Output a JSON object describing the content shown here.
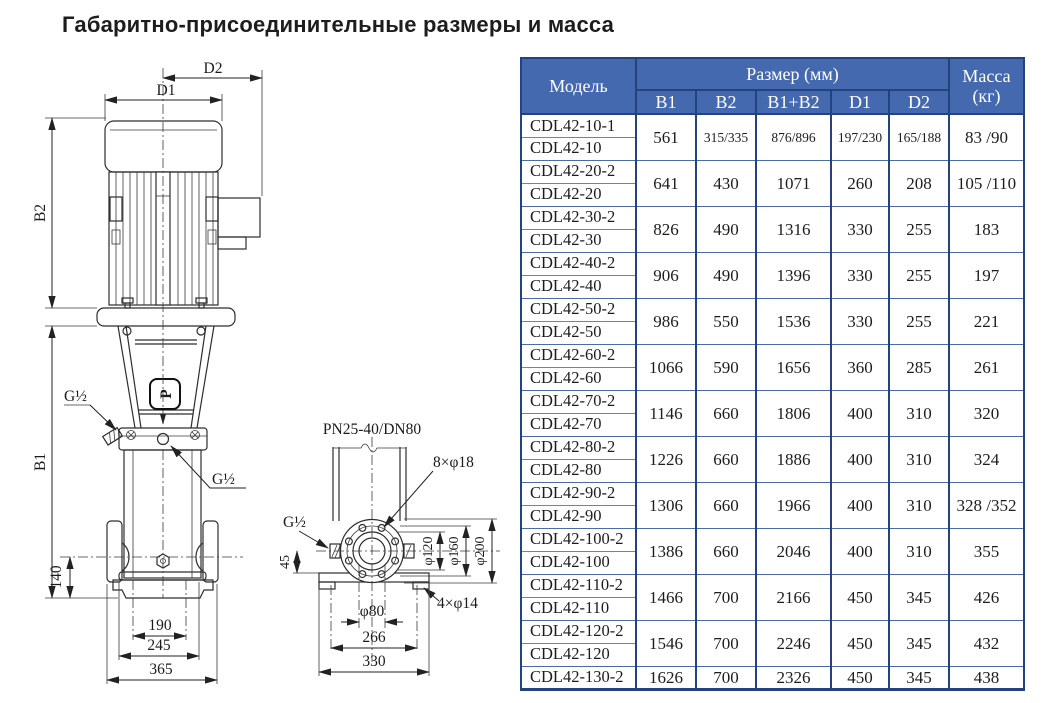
{
  "title": "Габаритно-присоединительные размеры и масса",
  "table": {
    "header": {
      "model": "Модель",
      "size_group": "Размер (мм)",
      "mass": "Масса (кг)",
      "size_cols": [
        "B1",
        "B2",
        "B1+B2",
        "D1",
        "D2"
      ]
    },
    "groups": [
      {
        "models": [
          "CDL42-10-1",
          "CDL42-10"
        ],
        "values": [
          "561",
          "315/335",
          "876/896",
          "197/230",
          "165/188",
          "83 /90"
        ],
        "small": true
      },
      {
        "models": [
          "CDL42-20-2",
          "CDL42-20"
        ],
        "values": [
          "641",
          "430",
          "1071",
          "260",
          "208",
          "105 /110"
        ]
      },
      {
        "models": [
          "CDL42-30-2",
          "CDL42-30"
        ],
        "values": [
          "826",
          "490",
          "1316",
          "330",
          "255",
          "183"
        ]
      },
      {
        "models": [
          "CDL42-40-2",
          "CDL42-40"
        ],
        "values": [
          "906",
          "490",
          "1396",
          "330",
          "255",
          "197"
        ]
      },
      {
        "models": [
          "CDL42-50-2",
          "CDL42-50"
        ],
        "values": [
          "986",
          "550",
          "1536",
          "330",
          "255",
          "221"
        ]
      },
      {
        "models": [
          "CDL42-60-2",
          "CDL42-60"
        ],
        "values": [
          "1066",
          "590",
          "1656",
          "360",
          "285",
          "261"
        ]
      },
      {
        "models": [
          "CDL42-70-2",
          "CDL42-70"
        ],
        "values": [
          "1146",
          "660",
          "1806",
          "400",
          "310",
          "320"
        ]
      },
      {
        "models": [
          "CDL42-80-2",
          "CDL42-80"
        ],
        "values": [
          "1226",
          "660",
          "1886",
          "400",
          "310",
          "324"
        ]
      },
      {
        "models": [
          "CDL42-90-2",
          "CDL42-90"
        ],
        "values": [
          "1306",
          "660",
          "1966",
          "400",
          "310",
          "328 /352"
        ]
      },
      {
        "models": [
          "CDL42-100-2",
          "CDL42-100"
        ],
        "values": [
          "1386",
          "660",
          "2046",
          "400",
          "310",
          "355"
        ]
      },
      {
        "models": [
          "CDL42-110-2",
          "CDL42-110"
        ],
        "values": [
          "1466",
          "700",
          "2166",
          "450",
          "345",
          "426"
        ]
      },
      {
        "models": [
          "CDL42-120-2",
          "CDL42-120"
        ],
        "values": [
          "1546",
          "700",
          "2246",
          "450",
          "345",
          "432"
        ]
      },
      {
        "models": [
          "CDL42-130-2"
        ],
        "values": [
          "1626",
          "700",
          "2326",
          "450",
          "345",
          "438"
        ]
      }
    ]
  },
  "drawing": {
    "front_view": {
      "dim_d2": "D2",
      "dim_d1": "D1",
      "dim_b2": "B2",
      "dim_b1": "B1",
      "dim_140": "140",
      "dim_190": "190",
      "dim_245": "245",
      "dim_365": "365",
      "port_side": "G½",
      "port_front": "G½",
      "logo": "P"
    },
    "flange_view": {
      "connection": "PN25-40/DN80",
      "bolt_holes": "8×φ18",
      "dia_120": "φ120",
      "dia_160": "φ160",
      "dia_200": "φ200",
      "dim_45": "45",
      "port": "G½",
      "base_holes": "4×φ14",
      "dia_80": "φ80",
      "dim_266": "266",
      "dim_330": "330"
    }
  },
  "colors": {
    "header_bg": "#4569ae",
    "grid_dark": "#24437c",
    "grid_group": "#4a6ca6",
    "body_text": "#1c1c1c"
  }
}
